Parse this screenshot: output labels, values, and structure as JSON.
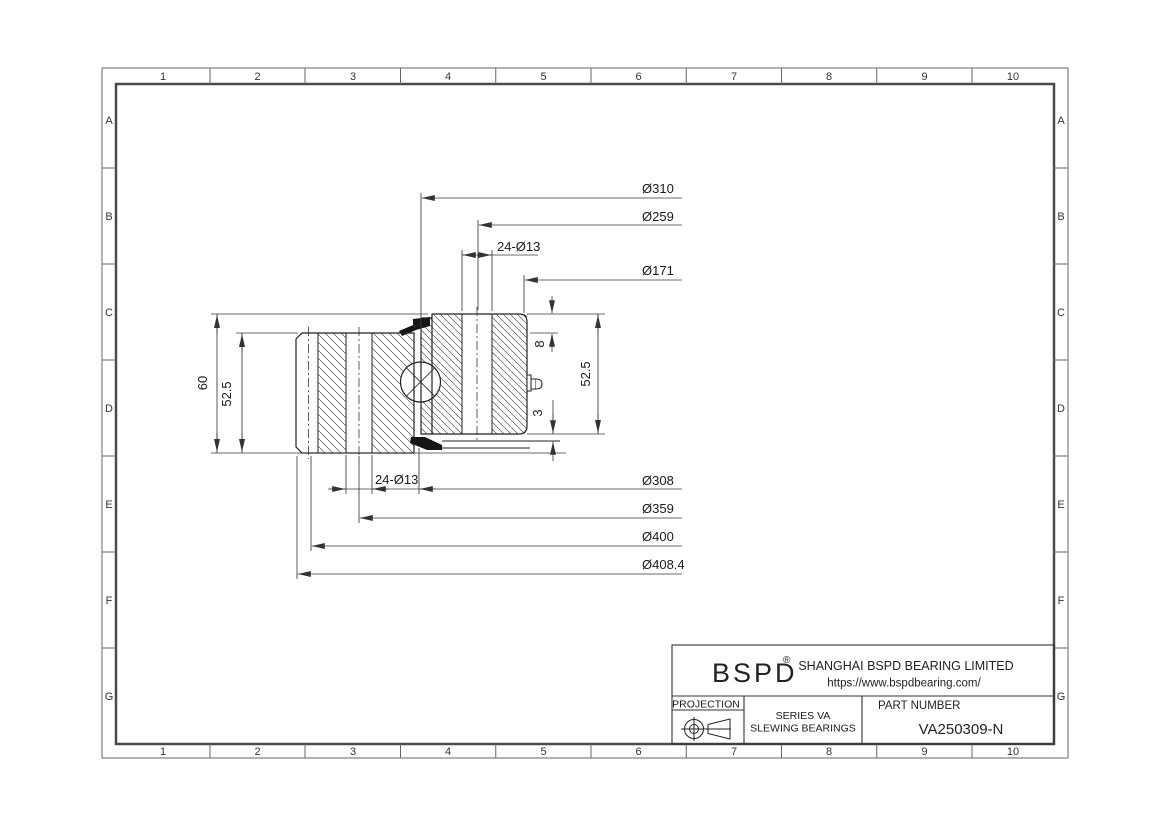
{
  "document_type": "engineering drawing sheet",
  "colors": {
    "background": "#ffffff",
    "part_outline": "#222222",
    "dimension_line": "#3a3a3a",
    "border_line": "#666666",
    "inner_border_line": "#4a4a4a",
    "hatch_line": "#555555",
    "seal_fill": "#151515"
  },
  "grid": {
    "cols": [
      "1",
      "2",
      "3",
      "4",
      "5",
      "6",
      "7",
      "8",
      "9",
      "10"
    ],
    "rows": [
      "A",
      "B",
      "C",
      "D",
      "E",
      "F",
      "G"
    ]
  },
  "dimensions": {
    "dia_310": "Ø310",
    "dia_259": "Ø259",
    "holes_top": "24-Ø13",
    "dia_171": "Ø171",
    "holes_bottom": "24-Ø13",
    "dia_308": "Ø308",
    "dia_359": "Ø359",
    "dia_400": "Ø400",
    "dia_408_4": "Ø408.4",
    "height_total": "60",
    "height_left_ring": "52.5",
    "step_top": "8",
    "step_bottom": "3",
    "height_right_ring": "52.5"
  },
  "title_block": {
    "logo": "BSPD",
    "registered_mark": "®",
    "company": "SHANGHAI BSPD BEARING LIMITED",
    "website": "https://www.bspdbearing.com/",
    "projection_label": "PROJECTION",
    "series_line1": "SERIES  VA",
    "series_line2": "SLEWING BEARINGS",
    "part_number_label": "PART  NUMBER",
    "part_number": "VA250309-N"
  }
}
